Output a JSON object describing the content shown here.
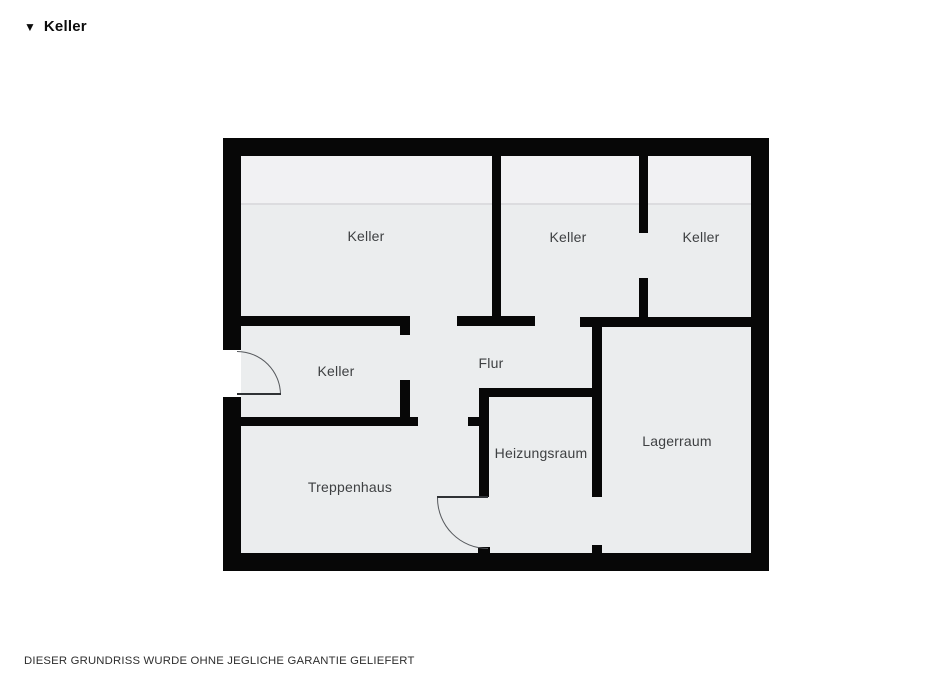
{
  "header": {
    "marker_icon": "▼",
    "title": "Keller"
  },
  "footer": {
    "disclaimer": "DIESER GRUNDRISS WURDE OHNE JEGLICHE GARANTIE GELIEFERT"
  },
  "colors": {
    "wall": "#070707",
    "room_fill": "#ebedee",
    "room_fill_upper": "#f1f1f3",
    "height_line": "#dcdcdf",
    "label_text": "#3e4042",
    "door_stroke": "#55585c",
    "page_background": "#ffffff"
  },
  "plan": {
    "floor": {
      "x": 241,
      "y": 156,
      "w": 510,
      "h": 397
    },
    "upper_strip": {
      "x": 241,
      "y": 156,
      "w": 510,
      "h": 48
    },
    "height_line": {
      "x": 241,
      "y": 203,
      "w": 510,
      "h": 2
    },
    "outer_walls": [
      {
        "name": "outer-wall-top",
        "x": 223,
        "y": 138,
        "w": 546,
        "h": 18
      },
      {
        "name": "outer-wall-bottom",
        "x": 223,
        "y": 553,
        "w": 546,
        "h": 18
      },
      {
        "name": "outer-wall-left-upper",
        "x": 223,
        "y": 138,
        "w": 18,
        "h": 212
      },
      {
        "name": "outer-wall-left-lower",
        "x": 223,
        "y": 397,
        "w": 18,
        "h": 174
      },
      {
        "name": "outer-wall-right",
        "x": 751,
        "y": 138,
        "w": 18,
        "h": 433
      }
    ],
    "inner_walls": [
      {
        "name": "wall-keller4-top",
        "x": 241,
        "y": 316,
        "w": 169,
        "h": 10
      },
      {
        "name": "wall-keller4-top-stub",
        "x": 400,
        "y": 316,
        "w": 10,
        "h": 19
      },
      {
        "name": "wall-mid-segment-b",
        "x": 457,
        "y": 316,
        "w": 78,
        "h": 10
      },
      {
        "name": "wall-keller1-keller2-divider",
        "x": 492,
        "y": 156,
        "w": 9,
        "h": 170
      },
      {
        "name": "wall-mid-segment-c",
        "x": 580,
        "y": 317,
        "w": 171,
        "h": 10
      },
      {
        "name": "wall-keller2-keller3-upper",
        "x": 639,
        "y": 156,
        "w": 9,
        "h": 77
      },
      {
        "name": "wall-keller2-keller3-lower",
        "x": 639,
        "y": 278,
        "w": 9,
        "h": 45
      },
      {
        "name": "wall-keller4-right",
        "x": 400,
        "y": 380,
        "w": 10,
        "h": 45
      },
      {
        "name": "wall-treppenhaus-top",
        "x": 241,
        "y": 417,
        "w": 177,
        "h": 9
      },
      {
        "name": "wall-flur-stub",
        "x": 468,
        "y": 417,
        "w": 11,
        "h": 9
      },
      {
        "name": "wall-heizungsraum-left",
        "x": 479,
        "y": 388,
        "w": 10,
        "h": 109
      },
      {
        "name": "wall-heizungsraum-top",
        "x": 479,
        "y": 388,
        "w": 123,
        "h": 9
      },
      {
        "name": "wall-lagerraum-left",
        "x": 592,
        "y": 327,
        "w": 10,
        "h": 170
      },
      {
        "name": "wall-door-stub-left",
        "x": 478,
        "y": 547,
        "w": 12,
        "h": 8
      },
      {
        "name": "wall-lagerraum-stub",
        "x": 592,
        "y": 545,
        "w": 10,
        "h": 10
      }
    ],
    "door_openings": [
      {
        "name": "entry-door-opening",
        "x": 223,
        "y": 350,
        "w": 18,
        "h": 47
      }
    ],
    "door_leaves": [
      {
        "name": "entry-door-leaf",
        "x": 237,
        "y": 393,
        "w": 44,
        "h": 2
      },
      {
        "name": "treppenhaus-door-leaf",
        "x": 437,
        "y": 496,
        "w": 51,
        "h": 2
      }
    ],
    "door_arcs": [
      {
        "name": "entry-door-arc",
        "x": 237,
        "y": 351,
        "w": 44,
        "h": 44,
        "corner": "tr"
      },
      {
        "name": "treppenhaus-door-arc",
        "x": 437,
        "y": 498,
        "w": 51,
        "h": 51,
        "corner": "bl"
      }
    ],
    "rooms": [
      {
        "label": "Keller",
        "cx": 366,
        "cy": 236
      },
      {
        "label": "Keller",
        "cx": 568,
        "cy": 237
      },
      {
        "label": "Keller",
        "cx": 701,
        "cy": 237
      },
      {
        "label": "Keller",
        "cx": 336,
        "cy": 371
      },
      {
        "label": "Flur",
        "cx": 491,
        "cy": 363
      },
      {
        "label": "Heizungsraum",
        "cx": 541,
        "cy": 453
      },
      {
        "label": "Lagerraum",
        "cx": 677,
        "cy": 441
      },
      {
        "label": "Treppenhaus",
        "cx": 350,
        "cy": 487
      }
    ]
  }
}
